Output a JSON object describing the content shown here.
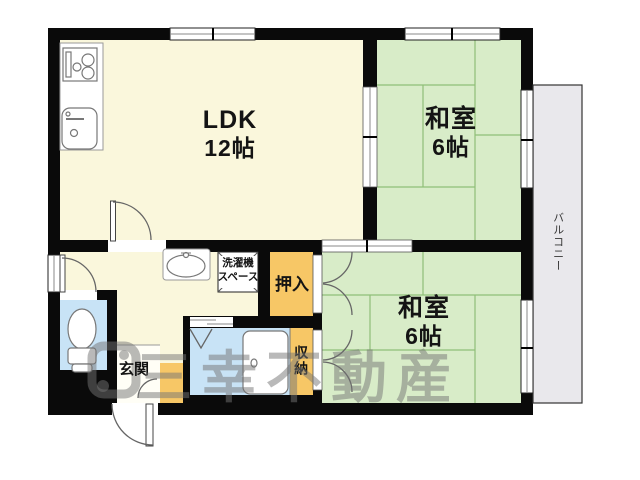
{
  "title": "間取り図",
  "rooms": {
    "ldk": {
      "name": "LDK",
      "size": "12帖"
    },
    "washitsu_top": {
      "name": "和室",
      "size": "6帖"
    },
    "washitsu_bottom": {
      "name": "和室",
      "size": "6帖"
    },
    "oshiire": {
      "label": "押入"
    },
    "shuno": {
      "label": "収納"
    },
    "genkan": {
      "label": "玄関"
    },
    "laundry": {
      "line1": "洗濯機",
      "line2": "スペース"
    },
    "balcony": {
      "label": "バルコニー"
    }
  },
  "icons": {
    "stove": "stove-icon",
    "kitchen_sink": "kitchen-sink-icon",
    "washbasin": "washbasin-icon",
    "toilet": "toilet-icon",
    "bathtub": "bathtub-icon",
    "shower": "shower-icon",
    "doors": "door-swing-icon",
    "windows": "window-icon",
    "fusuma": "sliding-door-icon"
  },
  "watermark": {
    "text": "三幸不動産"
  },
  "colors": {
    "wall": "#0a0a0a",
    "cream": "#faf7dc",
    "tatami": "#d8ecc8",
    "tatamiLine": "#8fbe77",
    "orange": "#f7c766",
    "blue": "#c8e3f6",
    "balcony": "#e9e8ec",
    "wm": "rgba(115,115,115,0.5)"
  }
}
